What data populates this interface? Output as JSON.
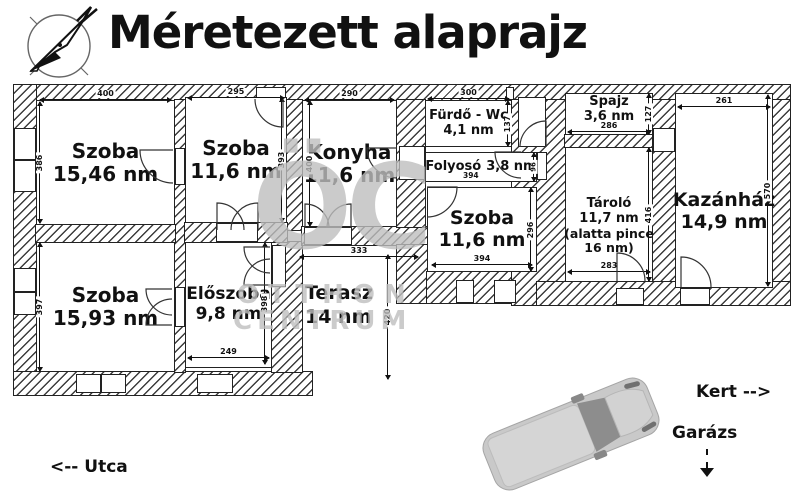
{
  "title": "Méretezett alaprajz",
  "rooms": [
    {
      "name": "Szoba",
      "area": "15,46 nm",
      "dim_top": "400",
      "dim_left": "386"
    },
    {
      "name": "Szoba",
      "area": "11,6 nm",
      "dim_top": "295",
      "dim_right": "393"
    },
    {
      "name": "Konyha",
      "area": "11,6 nm",
      "dim_top": "290",
      "dim_left": "400"
    },
    {
      "name": "Fürdő - Wc",
      "area": "4,1 nm",
      "dim_top": "300",
      "dim_right": "137"
    },
    {
      "name": "Folyosó",
      "area": "3,8 nm",
      "dim_bottom": "394",
      "dim_right": "96"
    },
    {
      "name": "Szoba",
      "area": "11,6 nm",
      "dim_bottom": "394",
      "dim_right": "296"
    },
    {
      "name": "Spajz",
      "area": "3,6 nm",
      "dim_bottom": "286",
      "dim_right": "127"
    },
    {
      "name": "Tároló",
      "area": "11,7 nm",
      "note": "(alatta pince 16 nm)",
      "dim_bottom": "283",
      "dim_right": "416"
    },
    {
      "name": "Kazánház",
      "area": "14,9 nm",
      "dim_top": "261",
      "dim_right": "570"
    },
    {
      "name": "Szoba",
      "area": "15,93 nm",
      "dim_left": "397"
    },
    {
      "name": "Előszoba",
      "area": "9,8 nm",
      "dim_bottom": "249",
      "dim_right": "398"
    },
    {
      "name": "Terasz",
      "area": "14 nm",
      "dim_top": "333",
      "dim_right": "420"
    }
  ],
  "annotations": {
    "street": "<-- Utca",
    "garden": "Kert -->",
    "garage": "Garázs"
  },
  "watermark": {
    "monogram": "ÖC",
    "line1": "OTTHON",
    "line2": "CENTRUM"
  },
  "colors": {
    "line": "#222222",
    "hatch": "#3c3c3c",
    "watermark": "#bebebe",
    "van_body": "#c9c9c9",
    "van_glass": "#8d8d8d"
  }
}
